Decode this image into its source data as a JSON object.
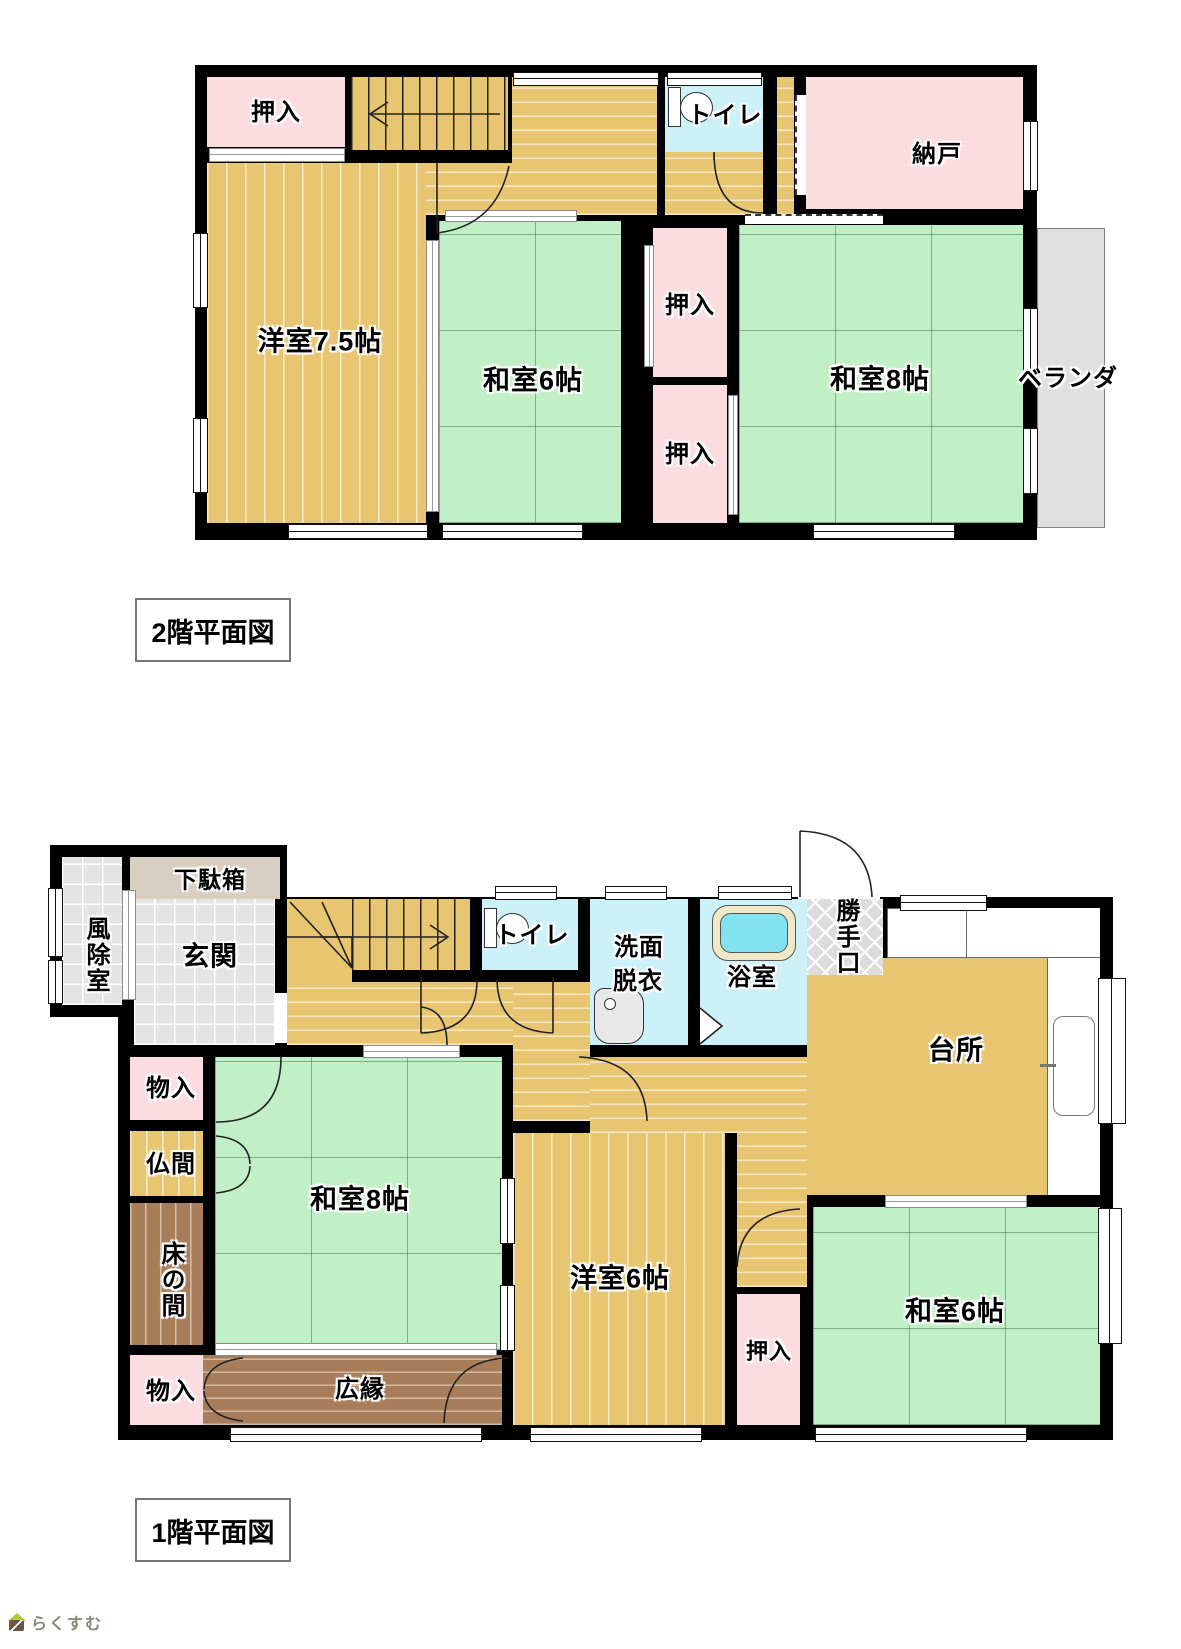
{
  "palette": {
    "wall": "#000000",
    "wood": "#E8C571",
    "tatami_green": "#C2F0C6",
    "closet_pink": "#FADCE1",
    "wet_blue": "#CDF1F9",
    "veranda_gray": "#E0E0E0",
    "tile_gray": "#E4E4E4",
    "engawa_brown": "#A87E5A",
    "shoe_cabinet_beige": "#D8CEC2",
    "logo_text_color": "#8E8373",
    "logo_roof_green": "#AECB3D"
  },
  "floor2": {
    "title": "2階平面図",
    "rooms": {
      "oshiire_tl": "押入",
      "toilet": "トイレ",
      "nando": "納戸",
      "yoshitsu75": "洋室7.5帖",
      "washitsu6": "和室6帖",
      "oshiire_mid_top": "押入",
      "oshiire_mid_bottom": "押入",
      "washitsu8": "和室8帖",
      "veranda": "ベランダ"
    }
  },
  "floor1": {
    "title": "1階平面図",
    "rooms": {
      "getabako": "下駄箱",
      "fujoshitsu": "風除室",
      "genkan": "玄関",
      "toilet": "トイレ",
      "senmen_line1": "洗面",
      "senmen_line2": "脱衣",
      "yokushitsu": "浴室",
      "katteguchi": "勝手口",
      "daidokoro": "台所",
      "monoire_top": "物入",
      "butsuma": "仏間",
      "tokonoma": "床の間",
      "washitsu8": "和室8帖",
      "yoshitsu6": "洋室6帖",
      "oshiire": "押入",
      "washitsu6": "和室6帖",
      "hiroen": "広縁",
      "monoire_bottom": "物入"
    }
  },
  "logo": {
    "text": "らくすむ"
  }
}
